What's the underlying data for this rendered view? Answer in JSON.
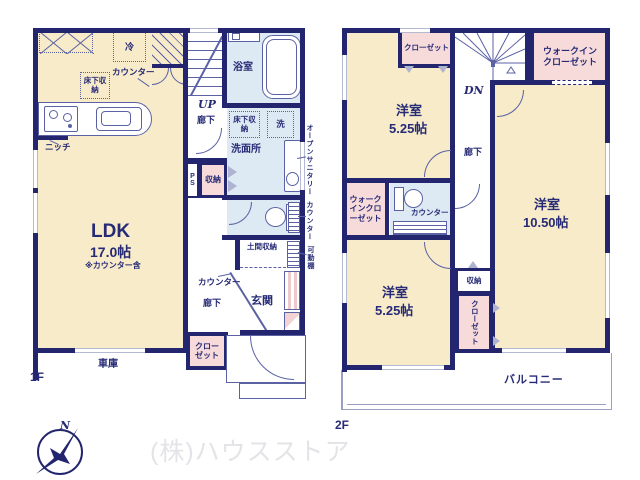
{
  "colors": {
    "wall": "#23266e",
    "ink": "#272b76",
    "line": "#5b62a4",
    "room_cream": "#f7ebc9",
    "closet_pink": "#f7dbdb",
    "sanitary_blue": "#dde9f3"
  },
  "compass_label": "N",
  "watermark": "(株)ハウスストア",
  "f1": {
    "floor_label": "1F",
    "ldk": {
      "name": "LDK",
      "size": "17.0帖",
      "note": "※カウンター含"
    },
    "kitchen": {
      "counter": "カウンター",
      "fridge": "冷",
      "floor_storage": "床下収納",
      "niche": "ニッチ"
    },
    "bath": "浴室",
    "stairs": {
      "dir": "UP",
      "hall": "廊下"
    },
    "washroom": {
      "name": "洗面所",
      "floor_storage": "床下収納",
      "laundry": "洗"
    },
    "open_sanitary": "オープンサニタリー",
    "ps": "PS",
    "storage": "収納",
    "side_counter": "カウンター",
    "doma_storage": "土間収納",
    "movable_shelf": "可動棚",
    "entry": {
      "name": "玄関",
      "hall": "廊下",
      "counter": "カウンター",
      "closet": "クローゼット"
    },
    "garage": "車庫"
  },
  "f2": {
    "floor_label": "2F",
    "closet_top": "クローゼット",
    "wic_right": "ウォークインクローゼット",
    "stairs": {
      "dir": "DN"
    },
    "room_a": {
      "name": "洋室",
      "size": "5.25帖"
    },
    "hall": "廊下",
    "wic_left": "ウォークインクローゼット",
    "toilet_counter": "カウンター",
    "room_b": {
      "name": "洋室",
      "size": "10.50帖"
    },
    "storage": "収納",
    "closet_mid": "クローゼット",
    "room_c": {
      "name": "洋室",
      "size": "5.25帖"
    },
    "balcony": "バルコニー"
  }
}
